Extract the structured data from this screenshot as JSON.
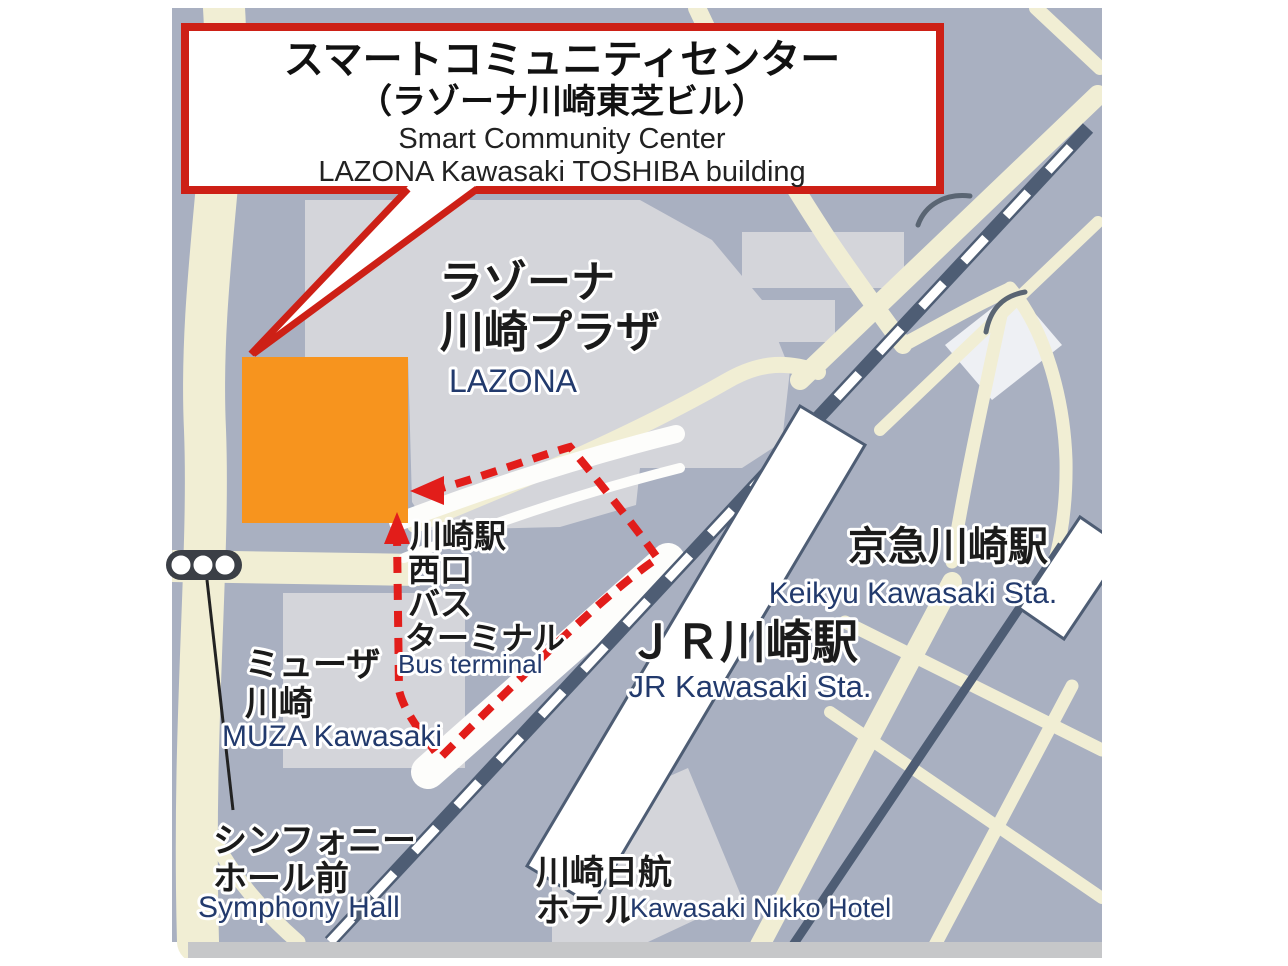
{
  "colors": {
    "map_bg": "#a9b0c1",
    "building_gray": "#d4d5da",
    "road_cream": "#f1eed4",
    "road_white": "#fdfdfb",
    "rail_dark": "#4e5d74",
    "accent_red": "#cd2016",
    "route_red": "#e21d1a",
    "building_orange": "#f7941e",
    "label_dark": "#1b1b1b",
    "label_navy": "#223a6d",
    "band_gray": "#c6c7c9"
  },
  "icons": {
    "traffic_light": "traffic-signal-three-lamps"
  },
  "callout": {
    "line1_ja": "スマートコミュニティセンター",
    "line2_ja": "（ラゾーナ川崎東芝ビル）",
    "line3_en": "Smart Community Center",
    "line4_en": "LAZONA Kawasaki TOSHIBA building"
  },
  "labels": {
    "lazona": {
      "ja1": "ラゾーナ",
      "ja2": "川崎プラザ",
      "en": "LAZONA"
    },
    "bus_terminal": {
      "ja1": "川崎駅",
      "ja2": "西口",
      "ja3": "バス",
      "ja4": "ターミナル",
      "en": "Bus terminal"
    },
    "muza": {
      "ja1": "ミューザ",
      "ja2": "川崎",
      "en": "MUZA Kawasaki"
    },
    "jr_station": {
      "ja": "ＪＲ川崎駅",
      "en": "JR Kawasaki Sta."
    },
    "keikyu_station": {
      "ja": "京急川崎駅",
      "en": "Keikyu Kawasaki Sta."
    },
    "symphony_hall": {
      "ja1": "シンフォニー",
      "ja2": "ホール前",
      "en": "Symphony Hall"
    },
    "nikko_hotel": {
      "ja1": "川崎日航",
      "ja2": "ホテル",
      "en": "Kawasaki Nikko Hotel"
    }
  }
}
